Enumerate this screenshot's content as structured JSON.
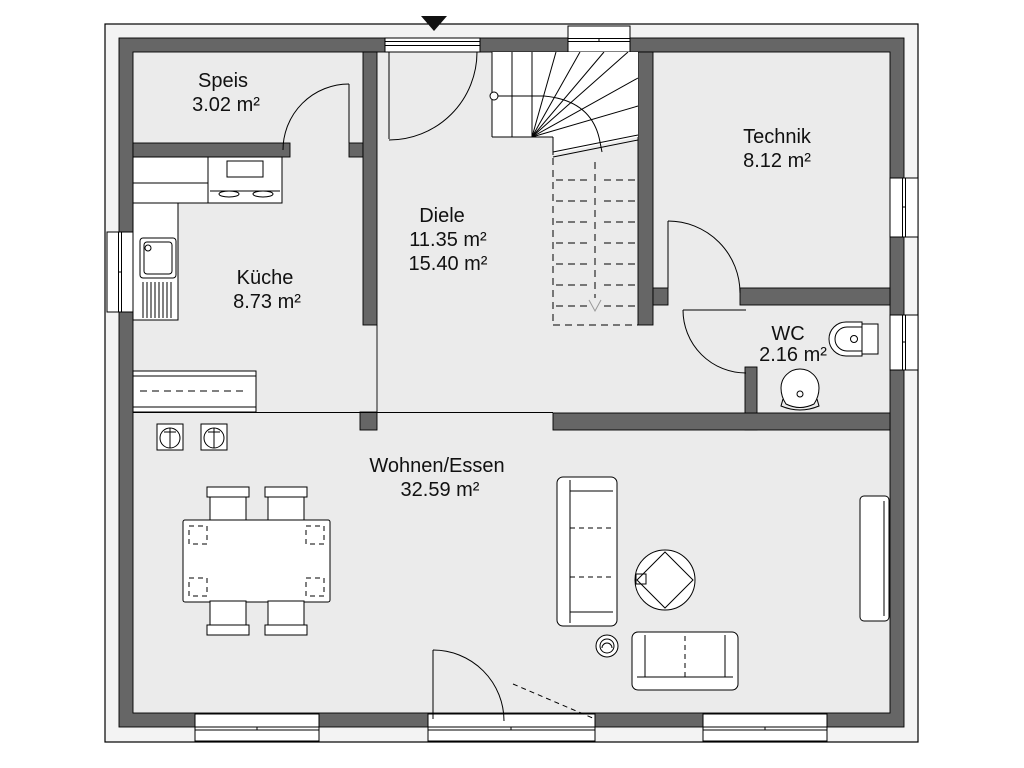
{
  "plan_type": "ground-floor-plan",
  "rooms": {
    "speis": {
      "name": "Speis",
      "area": "3.02 m²"
    },
    "kueche": {
      "name": "Küche",
      "area": "8.73 m²"
    },
    "diele": {
      "name": "Diele",
      "area": "11.35 m²",
      "area_total": "15.40 m²"
    },
    "technik": {
      "name": "Technik",
      "area": "8.12 m²"
    },
    "wc": {
      "name": "WC",
      "area": "2.16 m²"
    },
    "wohnen_essen": {
      "name": "Wohnen/Essen",
      "area": "32.59 m²"
    }
  },
  "symbols": {
    "entrance_marker": "black triangle pointing down at main entrance",
    "stair_direction": "gray dashed arrow pointing down (lower flight)"
  },
  "colors": {
    "wall_fill": "#666666",
    "floor_fill": "#ebebeb",
    "exterior_band": "#f3f3f3",
    "stair_fill": "#ffffff",
    "dashed_gray": "#999999",
    "line": "#000000",
    "label_text": "#111111"
  }
}
